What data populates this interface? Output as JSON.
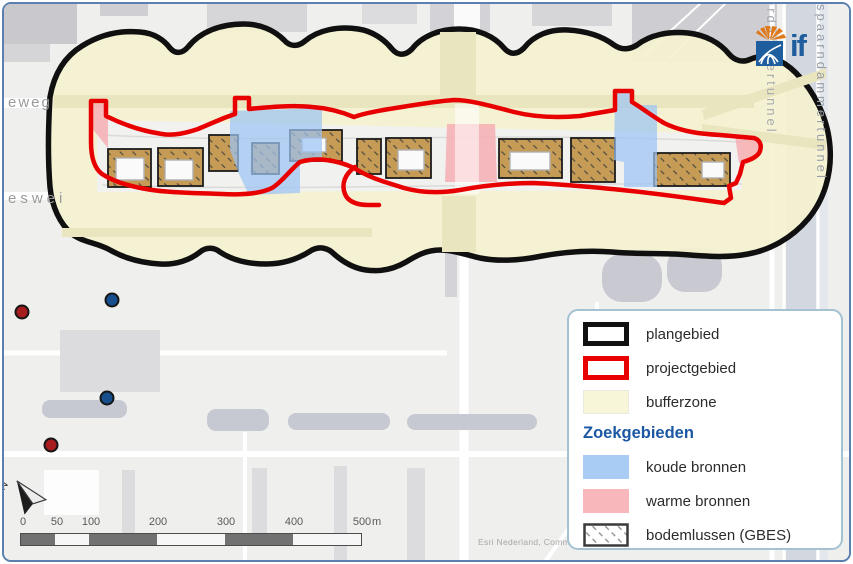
{
  "map": {
    "street_labels": {
      "top_left": "eweg",
      "mid_left": "eswei",
      "tunnel_a": "erdammertunnel",
      "tunnel_b": "spaarndammertunnel"
    },
    "attribution": "Esri Nederland, Commu",
    "logo_text": "if",
    "north_label": "N",
    "scalebar": {
      "ticks": [
        "0",
        "50",
        "100",
        "200",
        "300",
        "400",
        "500"
      ],
      "unit": "m"
    },
    "markers": [
      {
        "type": "warme bron (bestaand)",
        "color": "#a51d1d",
        "x": 20,
        "y": 310
      },
      {
        "type": "koude bron (bestaand)",
        "color": "#164f8c",
        "x": 110,
        "y": 298
      },
      {
        "type": "koude bron (bestaand)",
        "color": "#164f8c",
        "x": 105,
        "y": 396
      },
      {
        "type": "warme bron (bestaand)",
        "color": "#a51d1d",
        "x": 49,
        "y": 443
      }
    ],
    "zones": {
      "plangebied_outline_color": "#101010",
      "projectgebied_outline_color": "#e80000",
      "bufferzone_fill": "#f5f2d1",
      "koude_bronnen_fill": "#a9ccf5",
      "warme_bronnen_fill": "#f8b7bb",
      "bodemlussen_fill": "#c59b55"
    }
  },
  "legend": {
    "header": "Zoekgebieden",
    "items": [
      {
        "label": "plangebied",
        "swatch": "black-outline"
      },
      {
        "label": "projectgebied",
        "swatch": "red-outline"
      },
      {
        "label": "bufferzone",
        "swatch": "pale-yellow-fill"
      },
      {
        "label": "koude bronnen",
        "swatch": "blue-fill"
      },
      {
        "label": "warme bronnen",
        "swatch": "pink-fill"
      },
      {
        "label": "bodemlussen (GBES)",
        "swatch": "gray-hatch"
      }
    ]
  }
}
